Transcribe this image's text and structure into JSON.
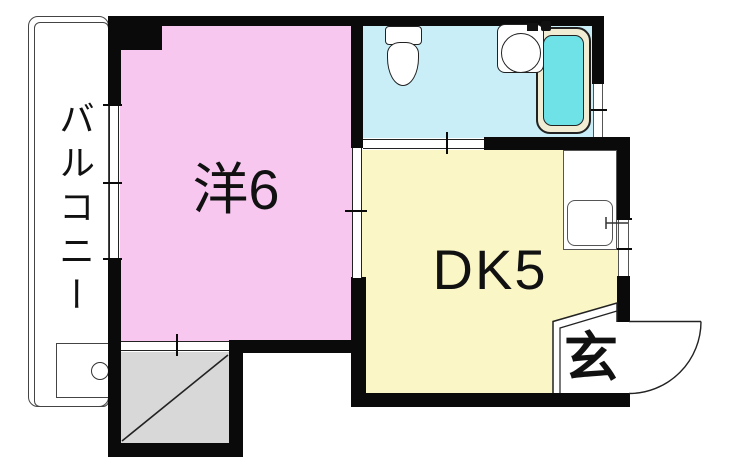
{
  "rooms": {
    "balcony": {
      "label": "バルコニー"
    },
    "western": {
      "label": "洋6"
    },
    "dining_kitchen": {
      "label": "DK5"
    },
    "entrance": {
      "label": "玄"
    }
  },
  "colors": {
    "wall": "#0a0a0a",
    "line": "#222222",
    "room_pink": "#f8c7f0",
    "room_yellow": "#faf6c6",
    "room_cyan": "#c9eef7",
    "tub_rim": "#f1ecd4",
    "tub_water": "#6fe2e8",
    "closet_gray": "#d8d8d8"
  }
}
